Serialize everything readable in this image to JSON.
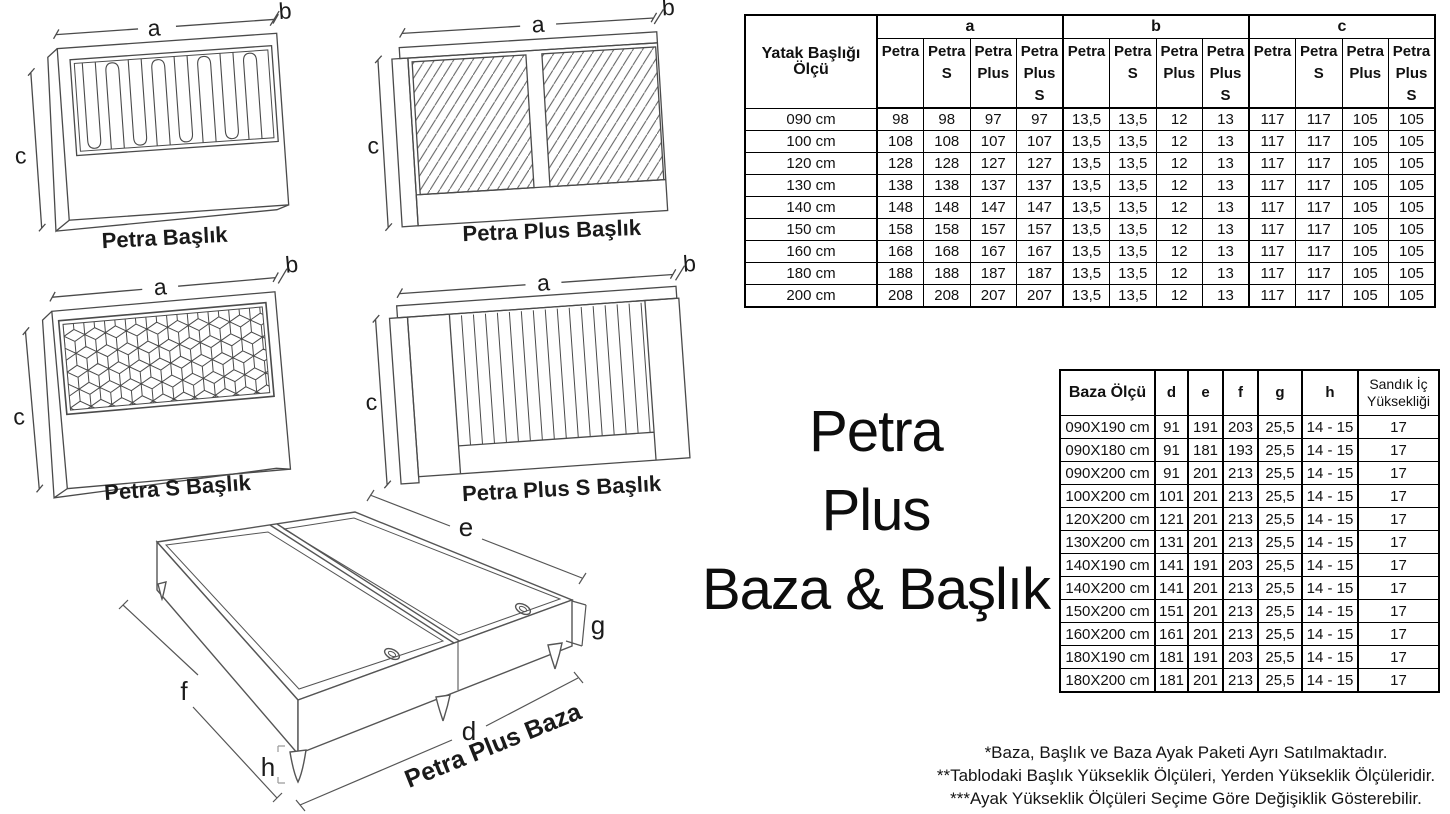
{
  "title": {
    "lines": [
      "Petra",
      "Plus",
      "Baza & Başlık"
    ]
  },
  "drawings": {
    "petra": {
      "caption": "Petra Başlık",
      "dim_a": "a",
      "dim_b": "b",
      "dim_c": "c"
    },
    "petra_plus": {
      "caption": "Petra Plus Başlık",
      "dim_a": "a",
      "dim_b": "b",
      "dim_c": "c"
    },
    "petra_s": {
      "caption": "Petra S Başlık",
      "dim_a": "a",
      "dim_b": "b",
      "dim_c": "c"
    },
    "petra_plus_s": {
      "caption": "Petra Plus S Başlık",
      "dim_a": "a",
      "dim_b": "b",
      "dim_c": "c"
    },
    "baza": {
      "caption": "Petra Plus Baza",
      "dim_d": "d",
      "dim_e": "e",
      "dim_f": "f",
      "dim_g": "g",
      "dim_h": "h"
    }
  },
  "headboard_table": {
    "corner_header": "Yatak Başlığı Ölçü",
    "group_headers": [
      "a",
      "b",
      "c"
    ],
    "sub_headers": [
      "Petra",
      "Petra\nS",
      "Petra\nPlus",
      "Petra\nPlus S"
    ],
    "rows": [
      {
        "size": "090 cm",
        "a": [
          "98",
          "98",
          "97",
          "97"
        ],
        "b": [
          "13,5",
          "13,5",
          "12",
          "13"
        ],
        "c": [
          "117",
          "117",
          "105",
          "105"
        ]
      },
      {
        "size": "100 cm",
        "a": [
          "108",
          "108",
          "107",
          "107"
        ],
        "b": [
          "13,5",
          "13,5",
          "12",
          "13"
        ],
        "c": [
          "117",
          "117",
          "105",
          "105"
        ]
      },
      {
        "size": "120 cm",
        "a": [
          "128",
          "128",
          "127",
          "127"
        ],
        "b": [
          "13,5",
          "13,5",
          "12",
          "13"
        ],
        "c": [
          "117",
          "117",
          "105",
          "105"
        ]
      },
      {
        "size": "130 cm",
        "a": [
          "138",
          "138",
          "137",
          "137"
        ],
        "b": [
          "13,5",
          "13,5",
          "12",
          "13"
        ],
        "c": [
          "117",
          "117",
          "105",
          "105"
        ]
      },
      {
        "size": "140 cm",
        "a": [
          "148",
          "148",
          "147",
          "147"
        ],
        "b": [
          "13,5",
          "13,5",
          "12",
          "13"
        ],
        "c": [
          "117",
          "117",
          "105",
          "105"
        ]
      },
      {
        "size": "150 cm",
        "a": [
          "158",
          "158",
          "157",
          "157"
        ],
        "b": [
          "13,5",
          "13,5",
          "12",
          "13"
        ],
        "c": [
          "117",
          "117",
          "105",
          "105"
        ]
      },
      {
        "size": "160 cm",
        "a": [
          "168",
          "168",
          "167",
          "167"
        ],
        "b": [
          "13,5",
          "13,5",
          "12",
          "13"
        ],
        "c": [
          "117",
          "117",
          "105",
          "105"
        ]
      },
      {
        "size": "180 cm",
        "a": [
          "188",
          "188",
          "187",
          "187"
        ],
        "b": [
          "13,5",
          "13,5",
          "12",
          "13"
        ],
        "c": [
          "117",
          "117",
          "105",
          "105"
        ]
      },
      {
        "size": "200 cm",
        "a": [
          "208",
          "208",
          "207",
          "207"
        ],
        "b": [
          "13,5",
          "13,5",
          "12",
          "13"
        ],
        "c": [
          "117",
          "117",
          "105",
          "105"
        ]
      }
    ]
  },
  "baza_table": {
    "headers": [
      "Baza Ölçü",
      "d",
      "e",
      "f",
      "g",
      "h",
      "Sandık İç\nYüksekliği"
    ],
    "rows": [
      [
        "090X190 cm",
        "91",
        "191",
        "203",
        "25,5",
        "14 - 15",
        "17"
      ],
      [
        "090X180 cm",
        "91",
        "181",
        "193",
        "25,5",
        "14 - 15",
        "17"
      ],
      [
        "090X200 cm",
        "91",
        "201",
        "213",
        "25,5",
        "14 - 15",
        "17"
      ],
      [
        "100X200 cm",
        "101",
        "201",
        "213",
        "25,5",
        "14 - 15",
        "17"
      ],
      [
        "120X200 cm",
        "121",
        "201",
        "213",
        "25,5",
        "14 - 15",
        "17"
      ],
      [
        "130X200 cm",
        "131",
        "201",
        "213",
        "25,5",
        "14 - 15",
        "17"
      ],
      [
        "140X190 cm",
        "141",
        "191",
        "203",
        "25,5",
        "14 - 15",
        "17"
      ],
      [
        "140X200 cm",
        "141",
        "201",
        "213",
        "25,5",
        "14 - 15",
        "17"
      ],
      [
        "150X200 cm",
        "151",
        "201",
        "213",
        "25,5",
        "14 - 15",
        "17"
      ],
      [
        "160X200 cm",
        "161",
        "201",
        "213",
        "25,5",
        "14 - 15",
        "17"
      ],
      [
        "180X190 cm",
        "181",
        "191",
        "203",
        "25,5",
        "14 - 15",
        "17"
      ],
      [
        "180X200 cm",
        "181",
        "201",
        "213",
        "25,5",
        "14 - 15",
        "17"
      ]
    ]
  },
  "notes": [
    "*Baza, Başlık ve Baza Ayak Paketi Ayrı Satılmaktadır.",
    "**Tablodaki Başlık Yükseklik Ölçüleri, Yerden Yükseklik Ölçüleridir.",
    "***Ayak Yükseklik Ölçüleri Seçime Göre Değişiklik Gösterebilir."
  ]
}
